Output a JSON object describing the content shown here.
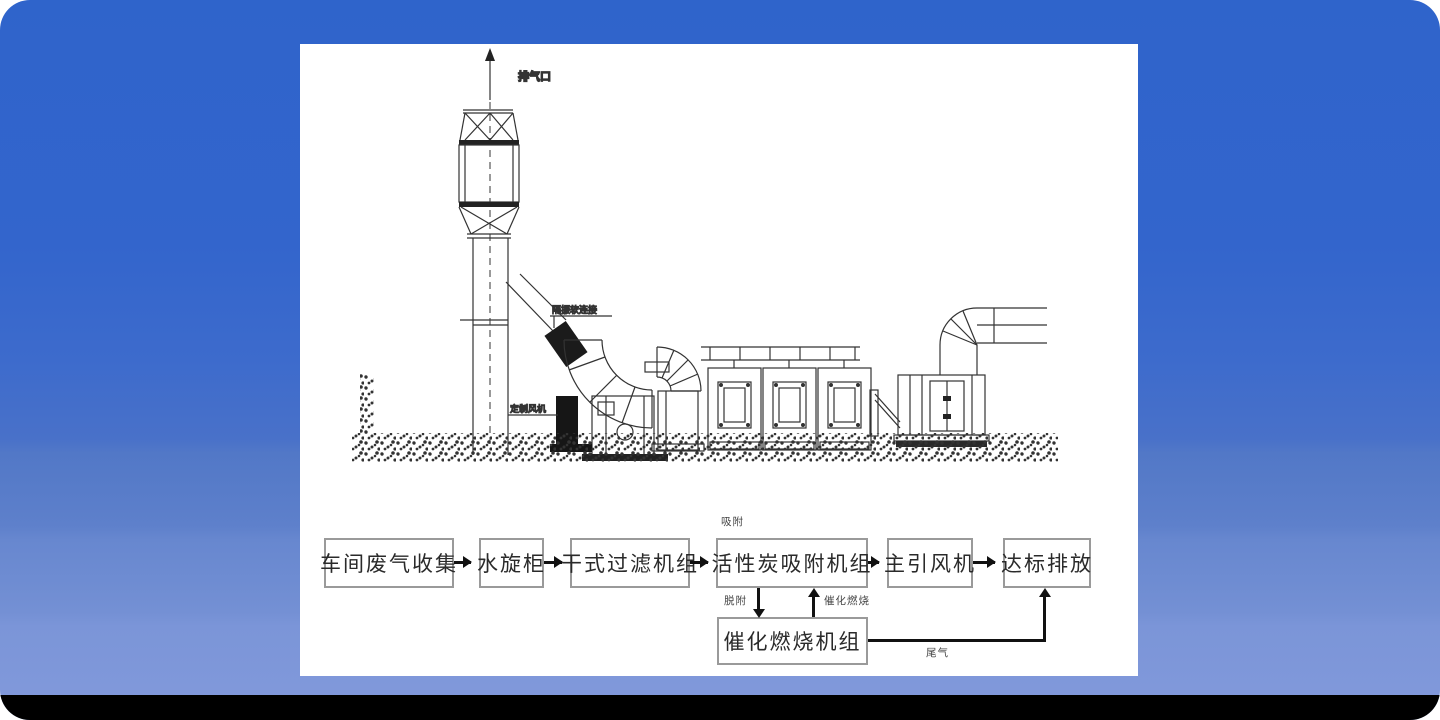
{
  "background": {
    "gradient_top": "#2f64cb",
    "gradient_bottom": "#8098da",
    "bottom_bar": "#000000",
    "panel": "#ffffff",
    "line_color": "#333333"
  },
  "diagram": {
    "labels": {
      "exhaust_outlet": "排气口",
      "flex_connection": "隔振软连接",
      "custom_fan": "定制风机"
    }
  },
  "flowchart": {
    "boxes": [
      {
        "id": "workshop-gas-collection",
        "label": "车间废气收集"
      },
      {
        "id": "water-spin-cabinet",
        "label": "水旋柜"
      },
      {
        "id": "dry-filter-unit",
        "label": "干式过滤机组"
      },
      {
        "id": "carbon-adsorption-unit",
        "label": "活性炭吸附机组"
      },
      {
        "id": "main-draft-fan",
        "label": "主引风机"
      },
      {
        "id": "compliant-discharge",
        "label": "达标排放"
      },
      {
        "id": "catalytic-combustion-unit",
        "label": "催化燃烧机组"
      }
    ],
    "annotations": {
      "adsorption": "吸附",
      "desorption": "脱附",
      "catalytic_combustion": "催化燃烧",
      "tail_gas": "尾气"
    }
  }
}
